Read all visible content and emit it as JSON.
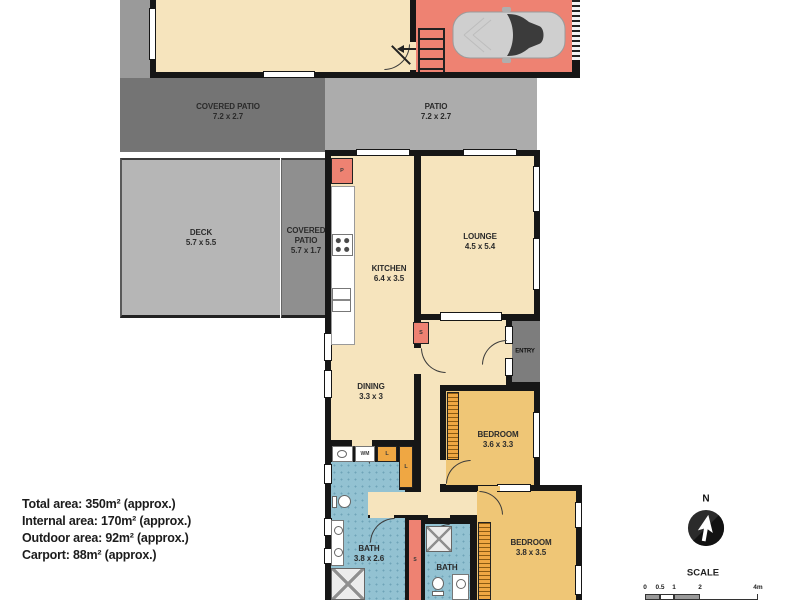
{
  "rooms": {
    "coveredPatioTop": {
      "name": "COVERED PATIO",
      "dims": "7.2 x 2.7"
    },
    "patio": {
      "name": "PATIO",
      "dims": "7.2 x 2.7"
    },
    "deck": {
      "name": "DECK",
      "dims": "5.7 x 5.5"
    },
    "coveredPatioSide": {
      "name": "COVERED PATIO",
      "dims": "5.7 x 1.7"
    },
    "kitchen": {
      "name": "KITCHEN",
      "dims": "6.4 x 3.5"
    },
    "lounge": {
      "name": "LOUNGE",
      "dims": "4.5 x 5.4"
    },
    "dining": {
      "name": "DINING",
      "dims": "3.3 x 3"
    },
    "entry": {
      "name": "ENTRY"
    },
    "bedroom1": {
      "name": "BEDROOM",
      "dims": "3.6 x 3.3"
    },
    "bedroom2": {
      "name": "BEDROOM",
      "dims": "3.8 x 3.5"
    },
    "bath1": {
      "name": "BATH",
      "dims": "3.8 x 2.6"
    },
    "bath2": {
      "name": "BATH"
    }
  },
  "markers": {
    "pantry": "P",
    "store": "S",
    "storeHall": "S",
    "linen": "L",
    "linen2": "L",
    "washingMachine": "WM"
  },
  "summary": {
    "total": "Total area: 350m² (approx.)",
    "internal": "Internal area: 170m² (approx.)",
    "outdoor": "Outdoor area: 92m² (approx.)",
    "carport": "Carport: 88m² (approx.)"
  },
  "compass": {
    "north": "N"
  },
  "scale": {
    "title": "SCALE",
    "ticks": [
      "0",
      "0.5",
      "1",
      "2",
      "4m"
    ]
  },
  "palette": {
    "wall": "#161616",
    "cream": "#F6E4BD",
    "gold": "#EFC676",
    "salmon": "#EE8272",
    "bath": "#93C2D2",
    "bathdot": "#6FA4B8",
    "patiodark": "#747474",
    "patiolight": "#ACACAC",
    "deckgray": "#B6B6B6",
    "patiomid": "#8F8F8F",
    "stripgray": "#9A9A9A",
    "entrygray": "#7D7D7D",
    "wardrobe": "#EFA743"
  }
}
